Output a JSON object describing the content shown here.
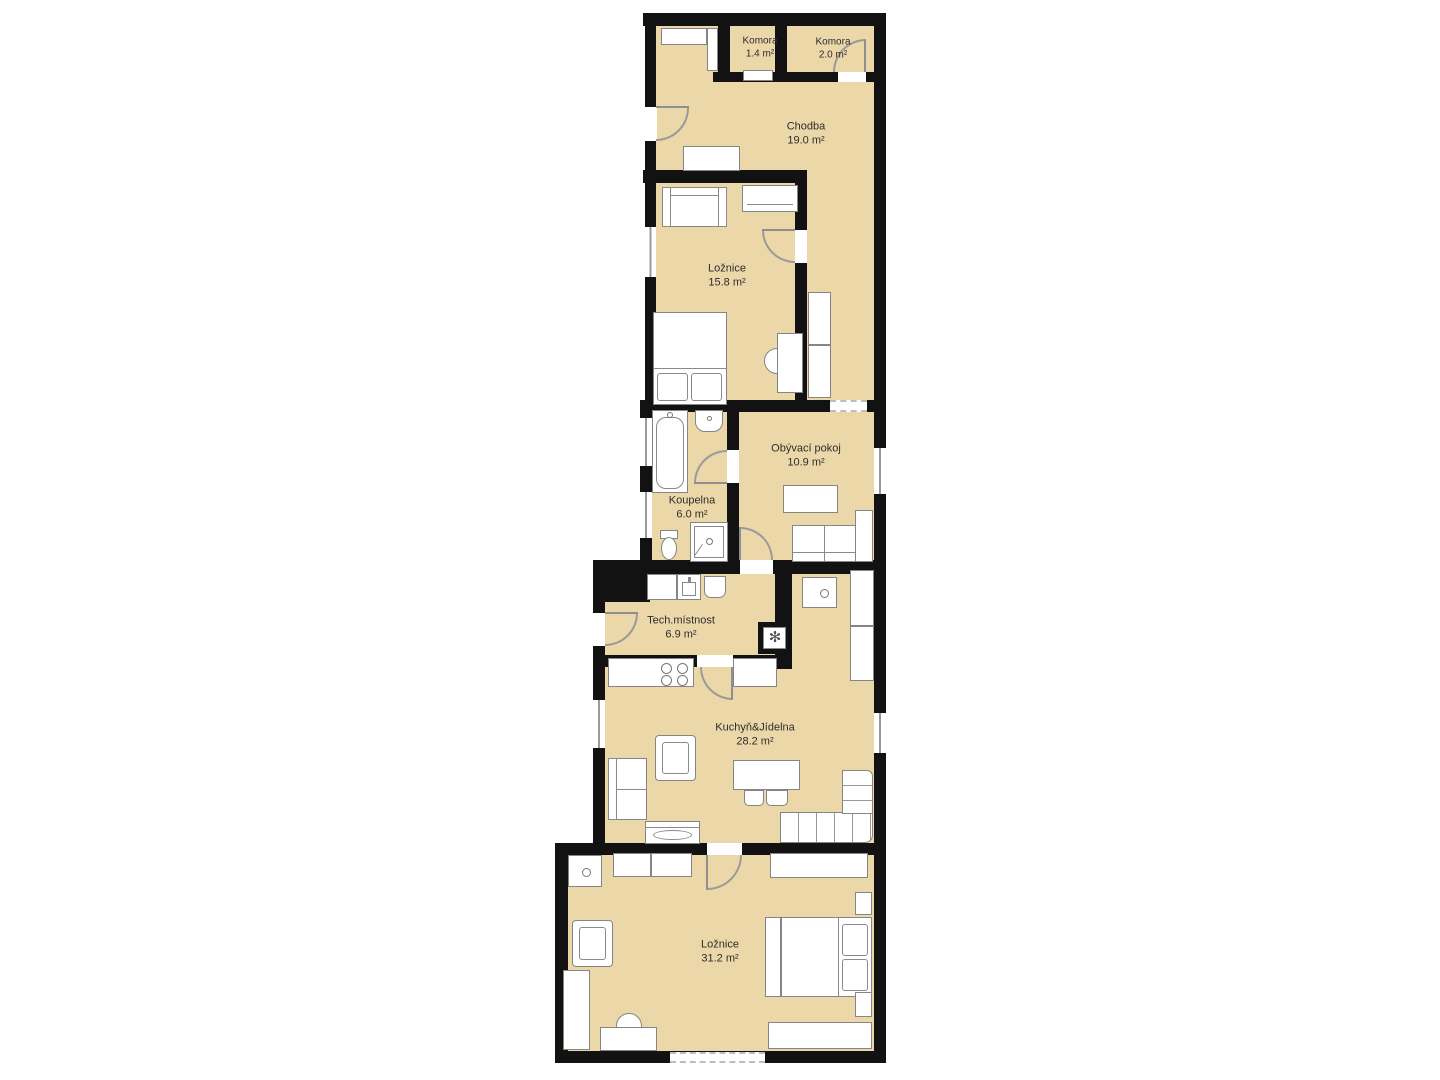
{
  "plan": {
    "type": "floor-plan",
    "units": "m²",
    "colors": {
      "floor": "#ecd7a9",
      "wall": "#121212",
      "furniture_outline": "#858585"
    },
    "rooms": {
      "komora1": {
        "name": "Komora",
        "area": "1.4 m²"
      },
      "komora2": {
        "name": "Komora",
        "area": "2.0 m²"
      },
      "chodba": {
        "name": "Chodba",
        "area": "19.0 m²"
      },
      "loznice_top": {
        "name": "Ložnice",
        "area": "15.8 m²"
      },
      "obyvaci": {
        "name": "Obývací pokoj",
        "area": "10.9 m²"
      },
      "koupelna": {
        "name": "Koupelna",
        "area": "6.0 m²"
      },
      "tech": {
        "name": "Tech.místnost",
        "area": "6.9 m²"
      },
      "kuchyn": {
        "name": "Kuchyň&Jídelna",
        "area": "28.2 m²"
      },
      "loznice_bot": {
        "name": "Ložnice",
        "area": "31.2 m²"
      }
    },
    "icons": {
      "hvac_fan": "✻"
    }
  }
}
